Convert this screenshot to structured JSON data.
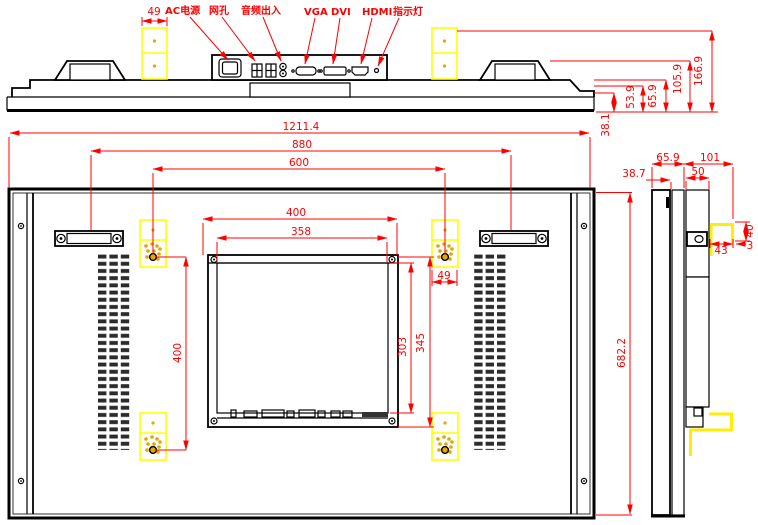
{
  "port_labels": {
    "ac_power": "AC电源",
    "lan": "网孔",
    "audio": "音频出入",
    "vga": "VGA",
    "dvi": "DVI",
    "hdmi": "HDMI",
    "indicator": "指示灯"
  },
  "top_dims": {
    "bracket_width": "49",
    "thickness_1": "38.1",
    "thickness_2": "53.9",
    "thickness_3": "65.9",
    "thickness_4": "105.9",
    "thickness_5": "166.9"
  },
  "front_dims": {
    "overall_width": "1211.4",
    "handle_spacing": "880",
    "bracket_spacing_h": "600",
    "module_width": "400",
    "module_face_width": "358",
    "bracket_spacing_v": "400",
    "module_height": "345",
    "module_face_height": "303",
    "overall_height": "682.2",
    "bracket_width": "49"
  },
  "side_dims": {
    "front_depth": "38.7",
    "panel_depth": "65.9",
    "total_depth": "101",
    "plate_width": "50",
    "hook_height": "40",
    "hook_width": "43",
    "hook_gap": "3"
  },
  "colors": {
    "dimension_red": "#fe0000",
    "bracket_yellow": "#ffff00",
    "line_black": "#000000"
  }
}
